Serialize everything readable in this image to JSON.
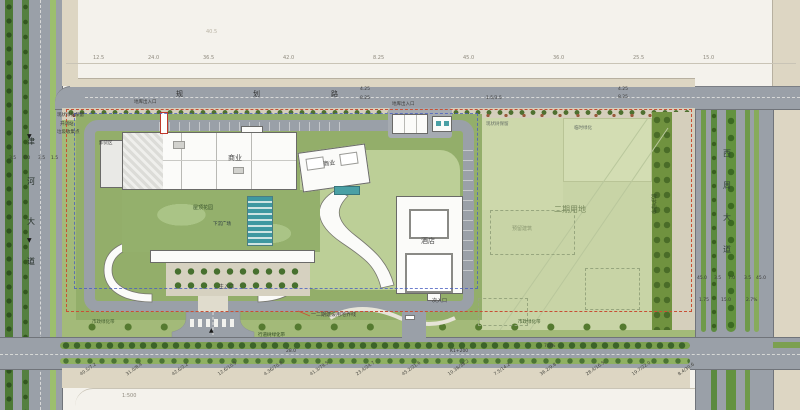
{
  "plan": {
    "type": "architectural-site-plan",
    "phases_note": "一二期建设用地界线",
    "scale_note": "1:500"
  },
  "colors": {
    "paper": "#f4f2ec",
    "road_gray": "#9aa0a8",
    "sidewalk_beige": "#ddd6c3",
    "site_verge_green": "#a3ba79",
    "built_lawn_green": "#93ae6a",
    "phase2_field_green": "#c8d4a6",
    "buffer_dark_green": "#70923f",
    "building_white": "#fbfbf9",
    "water_teal": "#3f98a0",
    "boundary_red": "#c94f35",
    "phase_line_blue": "#4a5fc0"
  },
  "roads": {
    "left": {
      "name": "津河大道",
      "chars": [
        "津",
        "河",
        "大",
        "道"
      ]
    },
    "right": {
      "name": "西周大道",
      "chars": [
        "西",
        "周",
        "大",
        "道"
      ]
    },
    "top": {
      "name": "规划路"
    }
  },
  "annotations": [
    {
      "t": "12.5",
      "x": 93,
      "y": 56,
      "s": 5,
      "c": "#8f8a7e"
    },
    {
      "t": "24.0",
      "x": 148,
      "y": 56,
      "s": 5,
      "c": "#8f8a7e"
    },
    {
      "t": "36.5",
      "x": 203,
      "y": 56,
      "s": 5,
      "c": "#8f8a7e"
    },
    {
      "t": "42.0",
      "x": 283,
      "y": 56,
      "s": 5,
      "c": "#8f8a7e"
    },
    {
      "t": "8.25",
      "x": 373,
      "y": 56,
      "s": 5,
      "c": "#8f8a7e"
    },
    {
      "t": "45.0",
      "x": 463,
      "y": 56,
      "s": 5,
      "c": "#8f8a7e"
    },
    {
      "t": "36.0",
      "x": 553,
      "y": 56,
      "s": 5,
      "c": "#8f8a7e"
    },
    {
      "t": "25.5",
      "x": 633,
      "y": 56,
      "s": 5,
      "c": "#8f8a7e"
    },
    {
      "t": "15.0",
      "x": 703,
      "y": 56,
      "s": 5,
      "c": "#8f8a7e"
    },
    {
      "t": "40.5",
      "x": 206,
      "y": 30,
      "s": 5,
      "c": "#b9b3a4"
    },
    {
      "t": "规",
      "x": 176,
      "y": 91,
      "s": 7,
      "c": "#2f2f2f"
    },
    {
      "t": "划",
      "x": 253,
      "y": 91,
      "s": 7,
      "c": "#2f2f2f"
    },
    {
      "t": "路",
      "x": 331,
      "y": 91,
      "s": 7,
      "c": "#2f2f2f"
    },
    {
      "t": "4.25",
      "x": 360,
      "y": 88,
      "s": 4.5
    },
    {
      "t": "8.25",
      "x": 360,
      "y": 97,
      "s": 4.5
    },
    {
      "t": "4.25",
      "x": 618,
      "y": 88,
      "s": 4.5
    },
    {
      "t": "8.25",
      "x": 618,
      "y": 96,
      "s": 4.5
    },
    {
      "t": "1.5/3.5",
      "x": 486,
      "y": 97,
      "s": 4.5
    },
    {
      "t": "▼",
      "x": 27,
      "y": 134,
      "s": 6,
      "c": "#1a1a1a"
    },
    {
      "t": "▼",
      "x": 27,
      "y": 238,
      "s": 6,
      "c": "#1a1a1a"
    },
    {
      "t": "▲",
      "x": 209,
      "y": 328,
      "s": 6,
      "c": "#1a1a1a"
    },
    {
      "t": "3.5",
      "x": 9,
      "y": 157,
      "s": 4.5
    },
    {
      "t": "7.0",
      "x": 23,
      "y": 157,
      "s": 4.5
    },
    {
      "t": "3.5",
      "x": 38,
      "y": 157,
      "s": 4.5
    },
    {
      "t": "1.5",
      "x": 51,
      "y": 157,
      "s": 4.5
    },
    {
      "t": "现状绿化保留",
      "x": 57,
      "y": 114,
      "s": 4.5
    },
    {
      "t": "开闭站",
      "x": 60,
      "y": 123,
      "s": 4.5
    },
    {
      "t": "垃圾收集点",
      "x": 57,
      "y": 131,
      "s": 4.5
    },
    {
      "t": "卸货区",
      "x": 99,
      "y": 142,
      "s": 4.5
    },
    {
      "t": "地库出入口",
      "x": 134,
      "y": 101,
      "s": 4.5
    },
    {
      "t": "商业",
      "x": 228,
      "y": 155,
      "s": 7,
      "c": "#4a4a4a"
    },
    {
      "t": "屋顶花园",
      "x": 193,
      "y": 206,
      "s": 5,
      "c": "#35502a"
    },
    {
      "t": "下沉广场",
      "x": 213,
      "y": 223,
      "s": 4.5,
      "c": "#24333f"
    },
    {
      "t": "主入口",
      "x": 219,
      "y": 285,
      "s": 5
    },
    {
      "t": "地库出入口",
      "x": 392,
      "y": 103,
      "s": 4.5
    },
    {
      "t": "商业",
      "x": 323,
      "y": 162,
      "s": 6,
      "r": -8
    },
    {
      "t": "酒店",
      "x": 421,
      "y": 238,
      "s": 7,
      "c": "#4a4a4a"
    },
    {
      "t": "次入口",
      "x": 432,
      "y": 299,
      "s": 5
    },
    {
      "t": "二期用地",
      "x": 554,
      "y": 206,
      "s": 8,
      "c": "#77885c"
    },
    {
      "t": "预留建筑",
      "x": 512,
      "y": 227,
      "s": 5,
      "c": "#8a9770"
    },
    {
      "t": "现状树保留",
      "x": 486,
      "y": 123,
      "s": 4.5,
      "c": "#667066"
    },
    {
      "t": "临时绿化",
      "x": 574,
      "y": 127,
      "s": 4.5,
      "c": "#667066"
    },
    {
      "t": "防护绿带",
      "x": 655,
      "y": 194,
      "s": 5,
      "c": "#2e4420",
      "r": 90
    },
    {
      "t": "一二期建设用地界线",
      "x": 311,
      "y": 313,
      "s": 5
    },
    {
      "t": "市政绿化带",
      "x": 92,
      "y": 321,
      "s": 4.5,
      "c": "#3f5a2c"
    },
    {
      "t": "市政绿化带",
      "x": 518,
      "y": 321,
      "s": 4.5,
      "c": "#3f5a2c"
    },
    {
      "t": "45.0",
      "x": 697,
      "y": 277,
      "s": 4.5
    },
    {
      "t": "3.5",
      "x": 714,
      "y": 277,
      "s": 4.5
    },
    {
      "t": "7.0",
      "x": 728,
      "y": 277,
      "s": 4.5
    },
    {
      "t": "3.5",
      "x": 744,
      "y": 277,
      "s": 4.5
    },
    {
      "t": "45.0",
      "x": 756,
      "y": 277,
      "s": 4.5
    },
    {
      "t": "1.75",
      "x": 699,
      "y": 299,
      "s": 4.5
    },
    {
      "t": "15.0",
      "x": 721,
      "y": 299,
      "s": 4.5
    },
    {
      "t": "2.7%",
      "x": 746,
      "y": 299,
      "s": 4.5
    },
    {
      "t": "行道树绿化带",
      "x": 258,
      "y": 334,
      "s": 4.5,
      "c": "#24401a"
    },
    {
      "t": "28.0",
      "x": 286,
      "y": 350,
      "s": 4.5
    },
    {
      "t": "K1+200",
      "x": 450,
      "y": 350,
      "s": 4.5
    },
    {
      "t": "7.0%",
      "x": 544,
      "y": 345,
      "s": 4.5
    },
    {
      "t": "40.5/7.2",
      "x": 80,
      "y": 374,
      "s": 4.5,
      "r": -35,
      "c": "#44453f"
    },
    {
      "t": "31.0/8.4",
      "x": 126,
      "y": 374,
      "s": 4.5,
      "r": -35,
      "c": "#44453f"
    },
    {
      "t": "42.6/2.2",
      "x": 172,
      "y": 374,
      "s": 4.5,
      "r": -35,
      "c": "#44453f"
    },
    {
      "t": "12.6/10.5",
      "x": 218,
      "y": 374,
      "s": 4.5,
      "r": -35,
      "c": "#44453f"
    },
    {
      "t": "4.36/70.8",
      "x": 264,
      "y": 374,
      "s": 4.5,
      "r": -35,
      "c": "#44453f"
    },
    {
      "t": "41.3/79.5",
      "x": 310,
      "y": 374,
      "s": 4.5,
      "r": -35,
      "c": "#44453f"
    },
    {
      "t": "23.4/24.7",
      "x": 356,
      "y": 374,
      "s": 4.5,
      "r": -35,
      "c": "#44453f"
    },
    {
      "t": "45.2/21.6",
      "x": 402,
      "y": 374,
      "s": 4.5,
      "r": -35,
      "c": "#44453f"
    },
    {
      "t": "10.36/38.2",
      "x": 448,
      "y": 374,
      "s": 4.5,
      "r": -35,
      "c": "#44453f"
    },
    {
      "t": "7.5/14.2",
      "x": 494,
      "y": 374,
      "s": 4.5,
      "r": -35,
      "c": "#44453f"
    },
    {
      "t": "36.2/9.8",
      "x": 540,
      "y": 374,
      "s": 4.5,
      "r": -35,
      "c": "#44453f"
    },
    {
      "t": "28.4/16.5",
      "x": 586,
      "y": 374,
      "s": 4.5,
      "r": -35,
      "c": "#44453f"
    },
    {
      "t": "19.7/22.0",
      "x": 632,
      "y": 374,
      "s": 4.5,
      "r": -35,
      "c": "#44453f"
    },
    {
      "t": "8.4/30.6",
      "x": 678,
      "y": 374,
      "s": 4.5,
      "r": -35,
      "c": "#44453f"
    },
    {
      "t": "1:500",
      "x": 122,
      "y": 394,
      "s": 5,
      "c": "#8f8a7e"
    }
  ]
}
